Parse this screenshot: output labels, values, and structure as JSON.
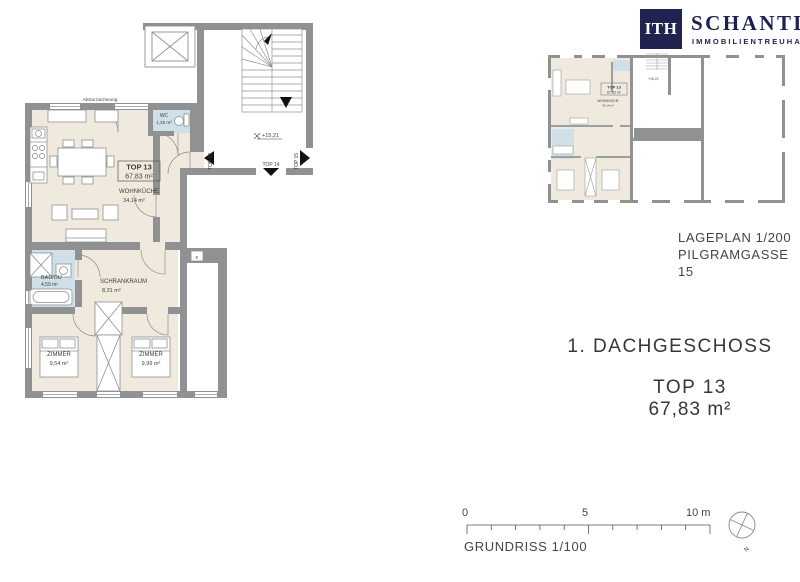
{
  "logo": {
    "mark": "ITH",
    "name": "SCHANTL",
    "subtitle": "IMMOBILIENTREUHAND"
  },
  "headings": {
    "floor": "1. DACHGESCHOSS",
    "unit": "TOP 13",
    "area": "67,83 m²"
  },
  "captions": {
    "lageplan": "LAGEPLAN 1/200",
    "address": "PILGRAMGASSE 15",
    "grundriss": "GRUNDRISS 1/100"
  },
  "plan": {
    "safety": "Absturzsicherung",
    "unit_box": {
      "title": "TOP 13",
      "area": "67,83 m²"
    },
    "level": "+15,21",
    "doors": {
      "t13": "TOP 13",
      "t14": "TOP 14",
      "t15": "TOP 15"
    },
    "shaft": "K",
    "rooms": {
      "wohnkueche": {
        "name": "WOHNKÜCHE",
        "area": "34,14 m²"
      },
      "wc": {
        "name": "WC",
        "area": "1,26 m²"
      },
      "schrankraum": {
        "name": "SCHRANKRAUM",
        "area": "8,31 m²"
      },
      "bad": {
        "name": "BAD/DU",
        "area": "4,59 m²"
      },
      "zimmer_left": {
        "name": "ZIMMER",
        "area": "9,54 m²"
      },
      "zimmer_right": {
        "name": "ZIMMER",
        "area": "9,99 m²"
      }
    }
  },
  "site_plan": {
    "unit": "TOP 13",
    "unit_area": "67,83 m²",
    "room": "WOHNKÜCHE",
    "room_area": "34,14 m²",
    "level": "+15,21"
  },
  "scale_bar": {
    "t0": "0",
    "t5": "5",
    "t10": "10 m",
    "north": "N"
  },
  "colors": {
    "wall": "#8f9193",
    "floor": "#f0e9dd",
    "wet_room": "#cfe0e8",
    "brand_navy": "#20224f",
    "line": "#8f9193"
  }
}
